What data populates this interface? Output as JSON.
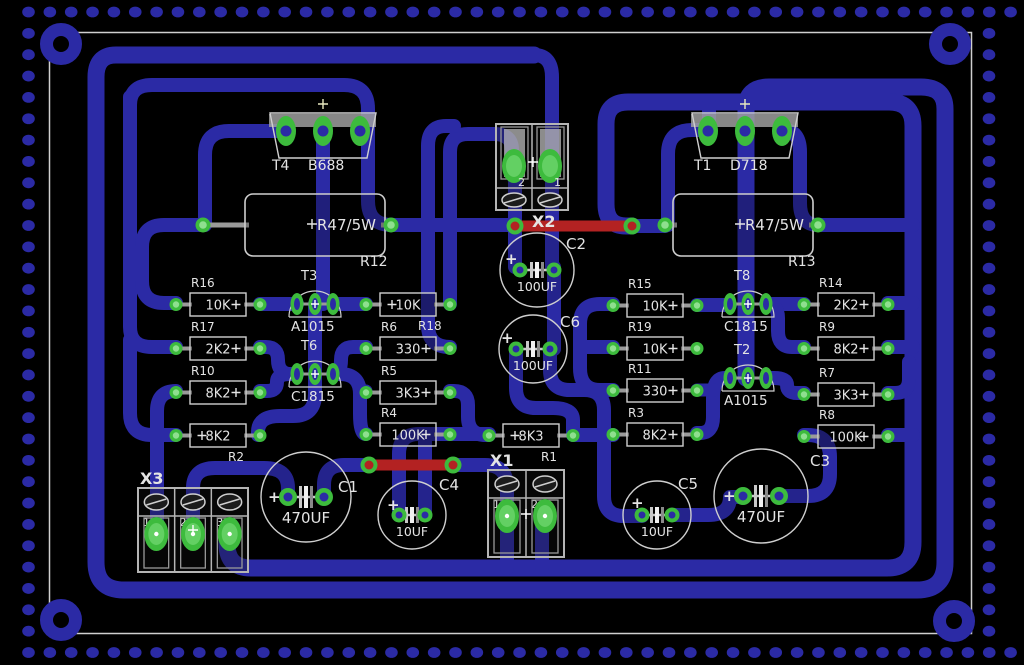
{
  "board": {
    "colors": {
      "background": "#000000",
      "trace": "#2b2aa5",
      "trace_red": "#b32222",
      "pad": "#3dbb3d",
      "pad_inner": "#8fdf8f",
      "pad_mid": "#63d063",
      "hole": "#2b2aa5",
      "outline": "#cfcfcf",
      "text": "#e4e4e4",
      "terminal": "#b5b5b5",
      "tab": "#9f9f9f"
    },
    "plus_glyph": "+"
  },
  "components": {
    "power_transistors": [
      {
        "ref": "T4",
        "part": "B688",
        "x": 269,
        "y": 113
      },
      {
        "ref": "T1",
        "part": "D718",
        "x": 691,
        "y": 113
      }
    ],
    "power_resistors": [
      {
        "ref": "R12",
        "value": "R47/5W",
        "x": 245,
        "y": 194,
        "pad_left_dx": -42,
        "pad_right_dx": 146
      },
      {
        "ref": "R13",
        "value": "R47/5W",
        "x": 673,
        "y": 194,
        "pad_left_dx": -8,
        "pad_right_dx": 145
      }
    ],
    "transistors": [
      {
        "ref": "T3",
        "part": "A1015",
        "cx": 315,
        "cy": 304
      },
      {
        "ref": "T6",
        "part": "C1815",
        "cx": 315,
        "cy": 374
      },
      {
        "ref": "T8",
        "part": "C1815",
        "cx": 748,
        "cy": 304
      },
      {
        "ref": "T2",
        "part": "A1015",
        "cx": 748,
        "cy": 378
      }
    ],
    "resistors": [
      {
        "ref": "R16",
        "value": "10K",
        "x": 190,
        "y": 293,
        "label": "above",
        "cross": "right"
      },
      {
        "ref": "R17",
        "value": "2K2",
        "x": 190,
        "y": 337,
        "label": "above",
        "cross": "right"
      },
      {
        "ref": "R10",
        "value": "8K2",
        "x": 190,
        "y": 381,
        "label": "above",
        "cross": "right"
      },
      {
        "ref": "R2",
        "value": "8K2",
        "x": 190,
        "y": 424,
        "label": "below",
        "cross": "left"
      },
      {
        "ref": "R18",
        "value": "10K",
        "x": 380,
        "y": 293,
        "label": "below",
        "cross": "left"
      },
      {
        "ref": "R6",
        "value": "330",
        "x": 380,
        "y": 337,
        "label": "above",
        "cross": "right"
      },
      {
        "ref": "R5",
        "value": "3K3",
        "x": 380,
        "y": 381,
        "label": "above",
        "cross": "right"
      },
      {
        "ref": "R4",
        "value": "100K",
        "x": 380,
        "y": 423,
        "label": "above",
        "cross": "right"
      },
      {
        "ref": "R1",
        "value": "8K3",
        "x": 503,
        "y": 424,
        "label": "below",
        "cross": "left"
      },
      {
        "ref": "R15",
        "value": "10K",
        "x": 627,
        "y": 294,
        "label": "above",
        "cross": "right"
      },
      {
        "ref": "R19",
        "value": "10K",
        "x": 627,
        "y": 337,
        "label": "above",
        "cross": "right"
      },
      {
        "ref": "R11",
        "value": "330",
        "x": 627,
        "y": 379,
        "label": "above",
        "cross": "right"
      },
      {
        "ref": "R3",
        "value": "8K2",
        "x": 627,
        "y": 423,
        "label": "above",
        "cross": "right"
      },
      {
        "ref": "R14",
        "value": "2K2",
        "x": 818,
        "y": 293,
        "label": "above",
        "cross": "right"
      },
      {
        "ref": "R9",
        "value": "8K2",
        "x": 818,
        "y": 337,
        "label": "above",
        "cross": "right"
      },
      {
        "ref": "R7",
        "value": "3K3",
        "x": 818,
        "y": 383,
        "label": "above",
        "cross": "right"
      },
      {
        "ref": "R8",
        "value": "100K",
        "x": 818,
        "y": 425,
        "label": "above",
        "cross": "right"
      }
    ],
    "capacitors": [
      {
        "ref": "C2",
        "value": "100UF",
        "cx": 537,
        "cy": 270,
        "r": 37,
        "pad_dx": 17,
        "plus_dx": -32,
        "plus_dy": -6,
        "label_x": 566,
        "label_y": 249
      },
      {
        "ref": "C6",
        "value": "100UF",
        "cx": 533,
        "cy": 349,
        "r": 34,
        "pad_dx": 17,
        "plus_dx": -32,
        "plus_dy": -6,
        "label_x": 560,
        "label_y": 327
      },
      {
        "ref": "C1",
        "value": "470UF",
        "cx": 306,
        "cy": 497,
        "r": 45,
        "pad_dx": 18,
        "plus_dx": -38,
        "plus_dy": 5,
        "label_x": 338,
        "label_y": 492
      },
      {
        "ref": "C4",
        "value": "10UF",
        "cx": 412,
        "cy": 515,
        "r": 34,
        "pad_dx": 13,
        "plus_dx": -25,
        "plus_dy": -5,
        "label_x": 439,
        "label_y": 490
      },
      {
        "ref": "C5",
        "value": "10UF",
        "cx": 657,
        "cy": 515,
        "r": 34,
        "pad_dx": 15,
        "plus_dx": -26,
        "plus_dy": -7,
        "label_x": 678,
        "label_y": 489
      },
      {
        "ref": "C3",
        "value": "470UF",
        "cx": 761,
        "cy": 496,
        "r": 47,
        "pad_dx": 18,
        "plus_dx": -38,
        "plus_dy": 5,
        "label_x": 810,
        "label_y": 466
      }
    ],
    "terminals": [
      {
        "ref": "X2",
        "x": 496,
        "y": 124,
        "w": 72,
        "h": 86,
        "pins": [
          "2",
          "1"
        ],
        "style": "pads-top",
        "label_x": 532,
        "label_y": 227
      },
      {
        "ref": "X3",
        "x": 138,
        "y": 488,
        "w": 110,
        "h": 84,
        "pins": [
          "1",
          "2",
          "3"
        ],
        "style": "screws-top",
        "label_x": 140,
        "label_y": 484
      },
      {
        "ref": "X1",
        "x": 488,
        "y": 470,
        "w": 76,
        "h": 87,
        "pins": [
          "1",
          "2"
        ],
        "style": "screws-top",
        "label_x": 490,
        "label_y": 466
      }
    ]
  }
}
